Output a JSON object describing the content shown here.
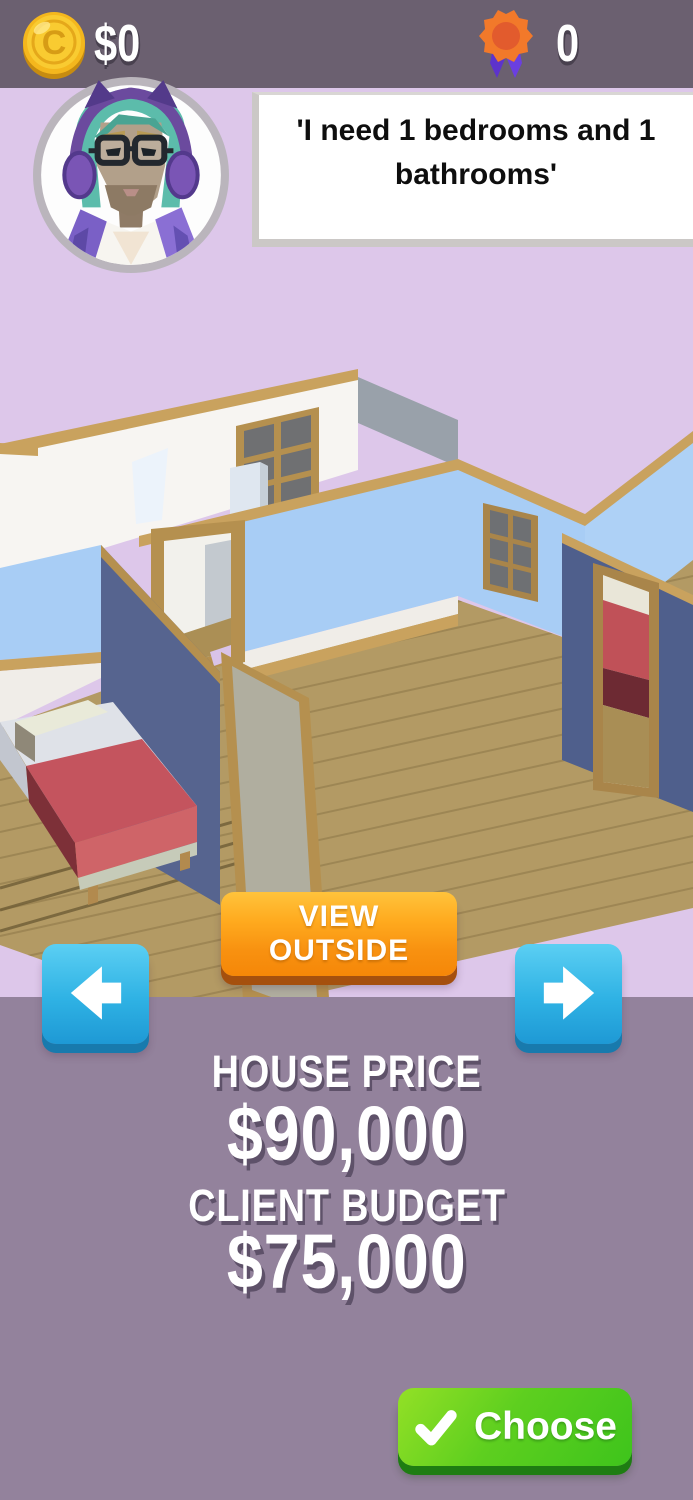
{
  "top_bar": {
    "coins": "$0",
    "awards": "0"
  },
  "client": {
    "speech": "'I need 1 bedrooms and 1 bathrooms'"
  },
  "house_view": {
    "view_outside": "VIEW OUTSIDE"
  },
  "pricing": {
    "house_price_label": "HOUSE PRICE",
    "house_price": "$90,000",
    "client_budget_label": "CLIENT BUDGET",
    "client_budget": "$75,000"
  },
  "actions": {
    "choose": "Choose"
  },
  "icons": {
    "currency": "coin-icon",
    "award": "rosette-ribbon-icon",
    "previous_house": "arrow-left-icon",
    "next_house": "arrow-right-icon",
    "choose_check": "check-icon",
    "client_portrait": "client-avatar"
  },
  "colors": {
    "top_bar_bg": "#6b6070",
    "scene_bg": "#ddc7ea",
    "panel_bg": "#93829c",
    "button_orange": "#f89110",
    "button_blue": "#2fb2e4",
    "button_green": "#3ec41c",
    "coin_gold": "#f6c526",
    "badge_orange": "#f2792a",
    "badge_ribbon_purple": "#5d33cc",
    "wall_white": "#f7f5f2",
    "wall_light_blue": "#a8cdf5",
    "wall_dark_slate": "#56648f",
    "wood_trim": "#c9a25e",
    "wood_floor": "#b39a64",
    "bed_red": "#c4545e"
  }
}
